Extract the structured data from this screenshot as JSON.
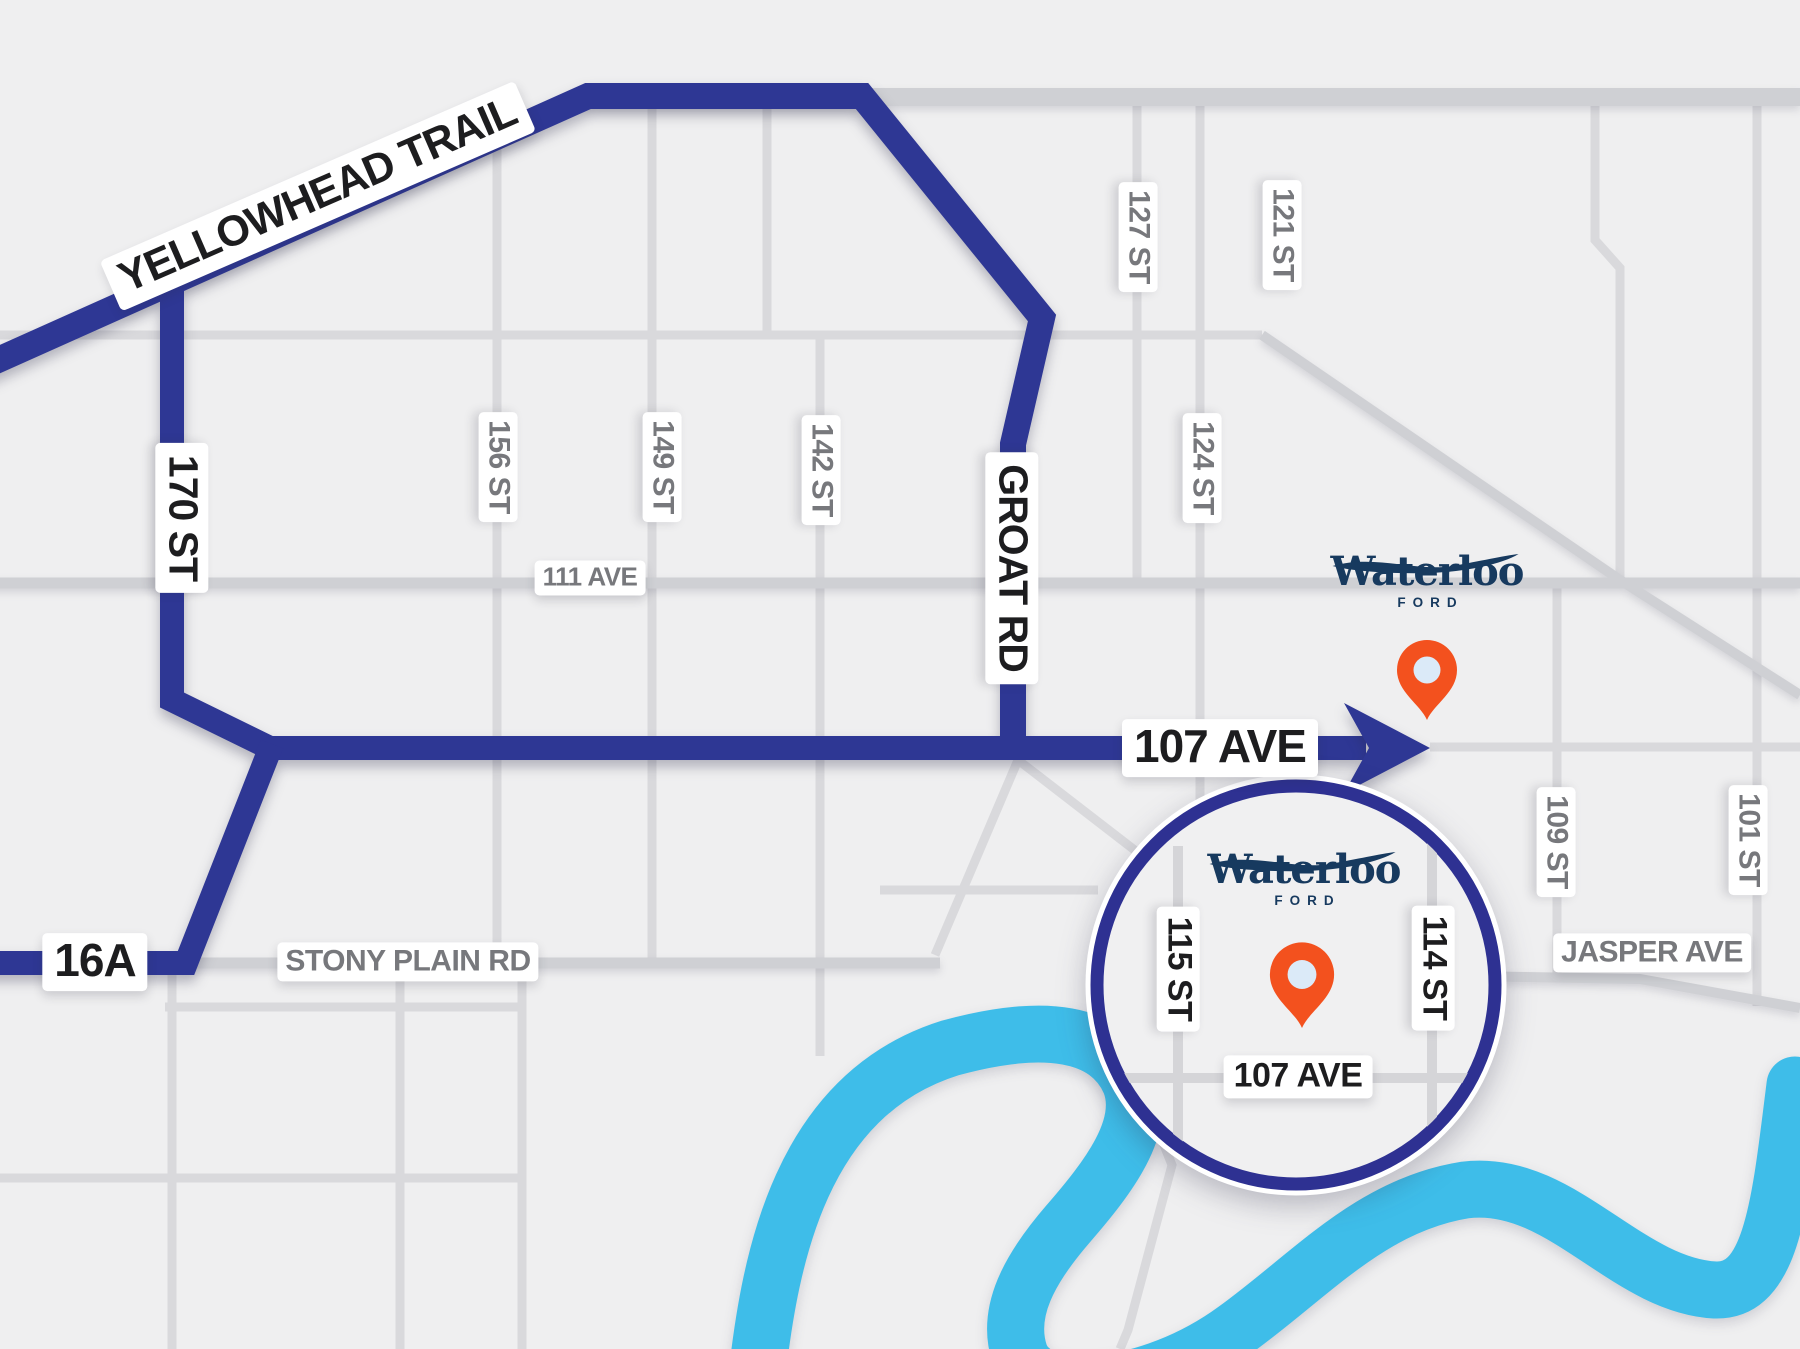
{
  "colors": {
    "background": "#efeff0",
    "minor_road": "#d9d9dc",
    "major_road": "#cfd0d4",
    "route_blue": "#2e3794",
    "river_blue": "#3ebde9",
    "inset_border": "#2e3192",
    "inset_fill": "#f0f0f1",
    "pin_orange": "#f3511e",
    "pin_center": "#dbeaf8",
    "brand_navy": "#173a5f",
    "label_black": "#1d1d1f",
    "label_gray": "#77787c"
  },
  "icons": {
    "pin": "location-pin",
    "arrow": "direction-arrow",
    "swoosh": "brand-swoosh"
  },
  "route_labels": {
    "yellowhead_trail": "YELLOWHEAD TRAIL",
    "st_170": "170 ST",
    "groat_rd": "GROAT RD",
    "ave_107": "107 AVE",
    "hwy_16a": "16A"
  },
  "street_labels": {
    "st_156": "156 ST",
    "st_149": "149 ST",
    "st_142": "142 ST",
    "st_127": "127 ST",
    "st_121": "121 ST",
    "st_124": "124 ST",
    "ave_111": "111 AVE",
    "stony_plain_rd": "STONY PLAIN RD",
    "jasper_ave": "JASPER AVE",
    "st_109": "109 ST",
    "st_101": "101 ST"
  },
  "inset": {
    "st_115": "115 ST",
    "st_114": "114 ST",
    "ave_107": "107 AVE"
  },
  "brand": {
    "name": "Waterloo",
    "division": "FORD"
  }
}
